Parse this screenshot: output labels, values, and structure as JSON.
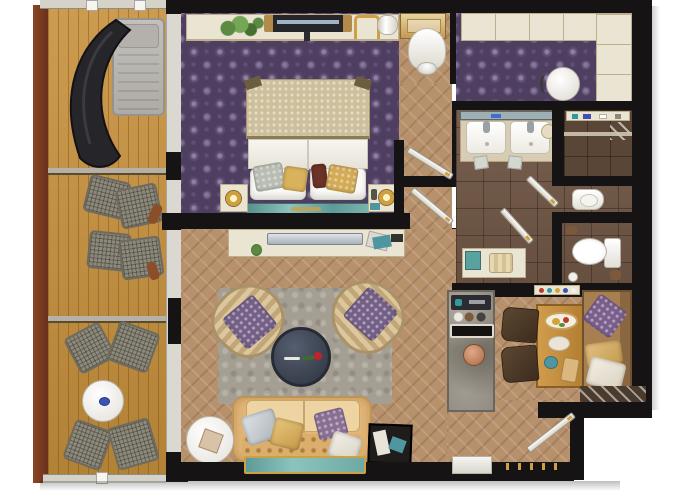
{
  "scene": {
    "kind": "floor-plan-rendering",
    "subject": "hotel suite top-down floor plan",
    "width_px": 680,
    "height_px": 491,
    "background": "#ffffff"
  },
  "palette": {
    "wall": "#161315",
    "glassWall": "#dbd8d2",
    "frame": "#7a3a22",
    "deck": "#c6903c",
    "rail": "#d5d2ca",
    "carpet": "#4e3e5f",
    "wood": "#b7916c",
    "tile": "#6f5645",
    "tileDark": "#5a4636",
    "cream": "#eae4d2",
    "creamEdge": "#bdae8d",
    "white": "#f3f1ec",
    "rug": "#a59f93",
    "sofa": "#e3b678",
    "sofaLight": "#eed3a3",
    "ottoman": "#3d4452",
    "purple": "#745f86",
    "teal": "#6fa9a4",
    "gold": "#cda043",
    "mesh": "#8d897b",
    "counter": "#8b867a",
    "tableWood": "#c28f42",
    "chairBrown": "#4a3828",
    "banquette": "#a87f50",
    "silver": "#c3c8cf",
    "copper": "#bf7f5a",
    "dark": "#26252a",
    "green": "#5d8a42",
    "blue": "#3a57b8",
    "maroon": "#6b3426",
    "mirror": "#9fb0b5",
    "landing": "#4a3b2d"
  },
  "rooms": [
    {
      "name": "balcony",
      "floor": "wood-decking",
      "furniture": [
        "sun-lounger",
        "curved-daybed",
        "mesh-chair",
        "mesh-chair",
        "mesh-chair",
        "mesh-chair",
        "mesh-chair",
        "mesh-chair",
        "round-table"
      ]
    },
    {
      "name": "bedroom",
      "floor": "purple-damask-carpet",
      "furniture": [
        "twin-bed-pair",
        "nightstand-left",
        "nightstand-right",
        "bedside-lamp",
        "bedside-lamp",
        "teal-bed-runner",
        "wall-console",
        "plant",
        "wall-tv",
        "gold-chair"
      ]
    },
    {
      "name": "vanity-passage",
      "floor": "herringbone-parquet",
      "furniture": [
        "vanity-desk",
        "tulip-chair"
      ]
    },
    {
      "name": "walk-in-wardrobe",
      "floor": "purple-damask-carpet",
      "furniture": [
        "closet-run-top",
        "closet-run-right",
        "pouf"
      ]
    },
    {
      "name": "bathroom",
      "floor": "brown-tile",
      "furniture": [
        "double-vanity",
        "shower-room",
        "bidet",
        "toilet",
        "towel-bench"
      ]
    },
    {
      "name": "corridor",
      "floor": "herringbone-parquet",
      "furniture": [
        "door-leaf",
        "door-leaf",
        "door-leaf"
      ]
    },
    {
      "name": "living-room",
      "floor": "herringbone-parquet",
      "furniture": [
        "area-rug",
        "tub-armchair-left",
        "tub-armchair-right",
        "round-ottoman-with-rose",
        "tufted-sofa",
        "throw-pillows",
        "round-side-table",
        "teal-bench",
        "luggage-bench",
        "tv-console"
      ]
    },
    {
      "name": "kitchenette-dining",
      "floor": "herringbone-parquet",
      "furniture": [
        "stone-counter",
        "coffee-machine",
        "black-tray",
        "copper-kettle",
        "minibar-shelf",
        "dining-table",
        "dining-chair",
        "dining-chair",
        "banquette-with-pillows"
      ]
    },
    {
      "name": "entry",
      "floor": "herringbone-parquet",
      "furniture": [
        "entry-door-leaf",
        "threshold",
        "outside-landing"
      ]
    }
  ]
}
